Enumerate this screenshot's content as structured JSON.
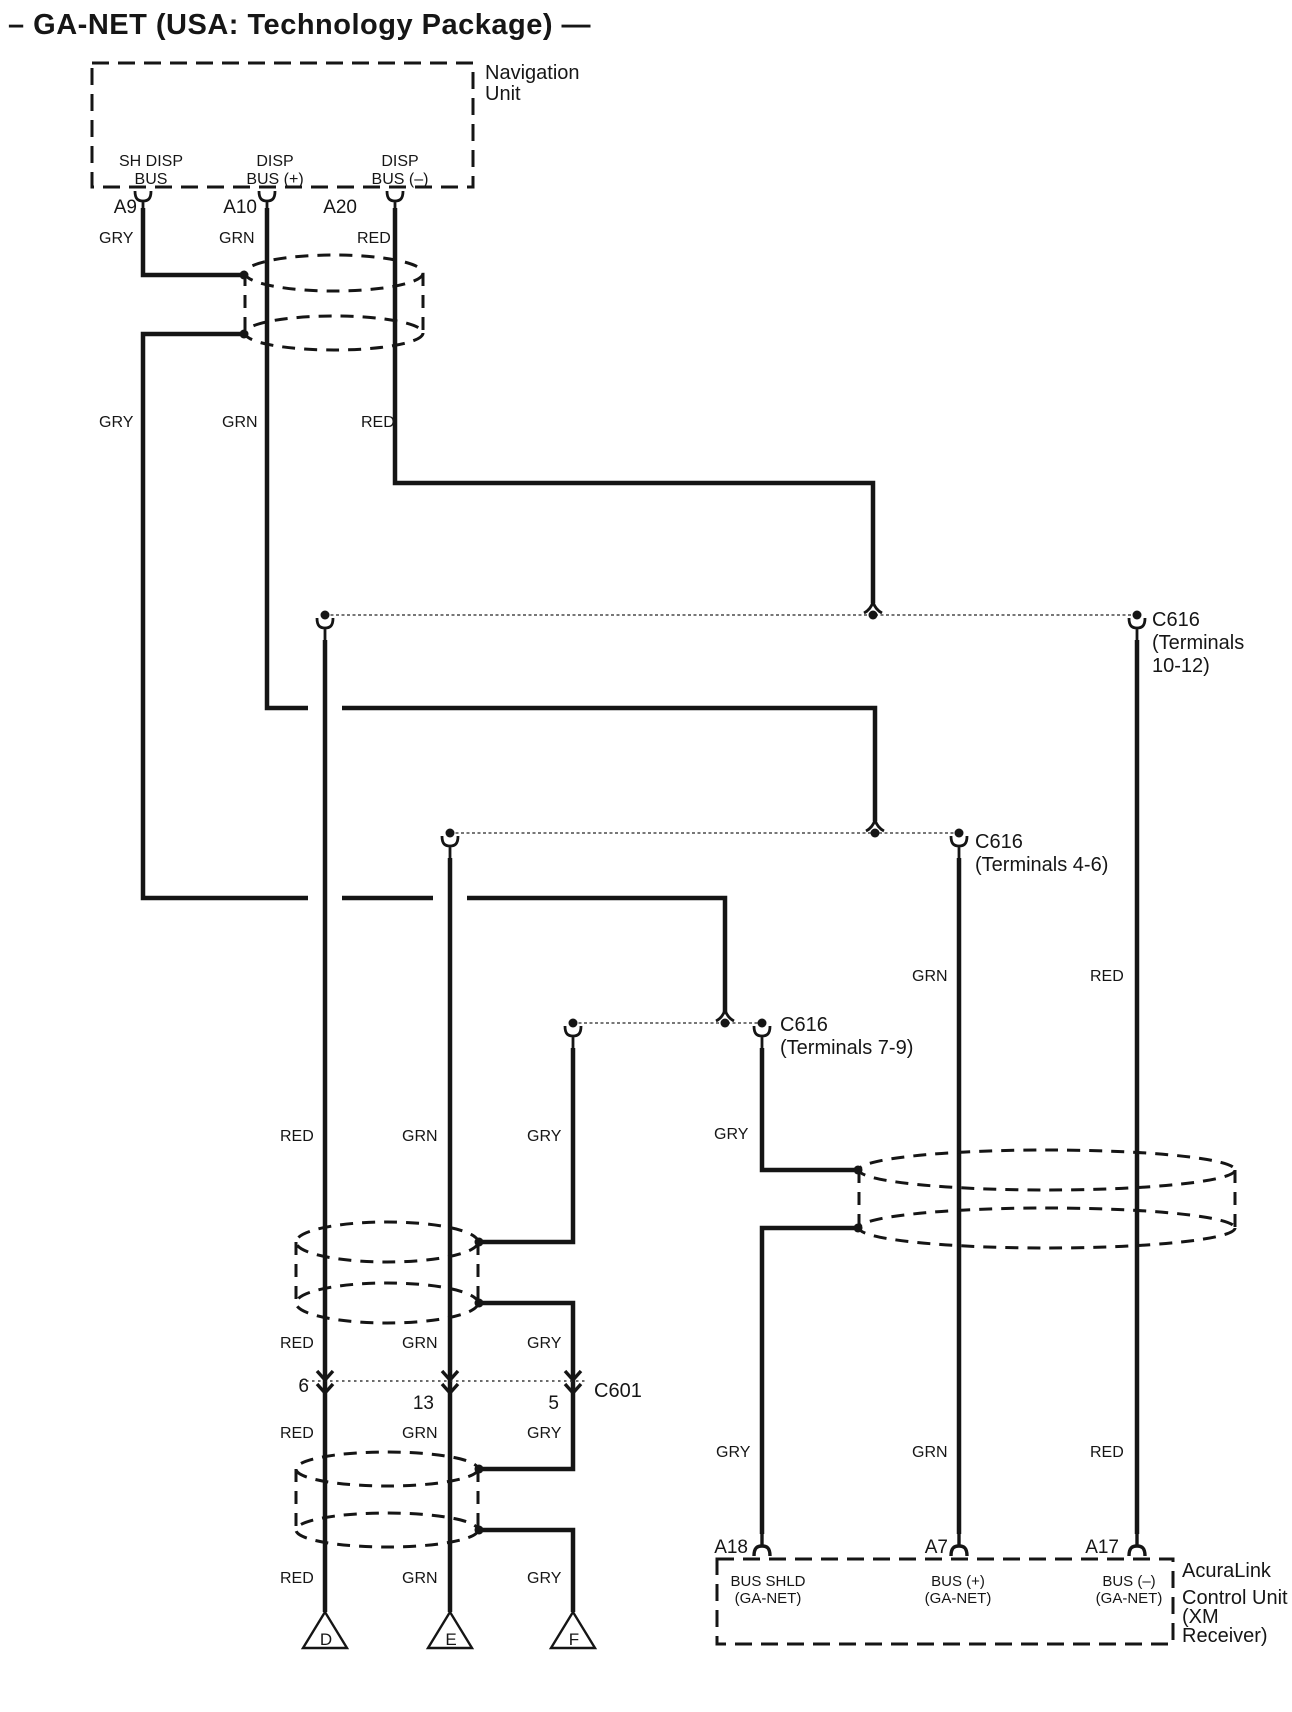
{
  "title": "– GA-NET (USA: Technology Package) —",
  "navigation_unit": {
    "label": [
      "Navigation",
      "Unit"
    ],
    "pins": [
      {
        "id": "A9",
        "bus": [
          "SH DISP",
          "BUS"
        ],
        "wire": "GRY"
      },
      {
        "id": "A10",
        "bus": [
          "DISP",
          "BUS (+)"
        ],
        "wire": "GRN"
      },
      {
        "id": "A20",
        "bus": [
          "DISP",
          "BUS (–)"
        ],
        "wire": "RED"
      }
    ]
  },
  "wire_labels": {
    "tier2": [
      "GRY",
      "GRN",
      "RED"
    ],
    "left_mid": [
      "RED",
      "GRN",
      "GRY"
    ],
    "left_above_c601": [
      "RED",
      "GRN",
      "GRY"
    ],
    "left_below_c601": [
      "RED",
      "GRN",
      "GRY"
    ],
    "left_bottom": [
      "RED",
      "GRN",
      "GRY"
    ],
    "right_upper": [
      "GRN",
      "RED"
    ],
    "right_gry": "GRY",
    "right_lower": [
      "GRY",
      "GRN",
      "RED"
    ]
  },
  "connectors": {
    "c616_10_12": [
      "C616",
      "(Terminals",
      "10-12)"
    ],
    "c616_4_6": [
      "C616",
      "(Terminals 4-6)"
    ],
    "c616_7_9": [
      "C616",
      "(Terminals 7-9)"
    ],
    "c601": {
      "label": "C601",
      "pins": [
        "6",
        "13",
        "5"
      ]
    }
  },
  "ring_terminals": [
    "D",
    "E",
    "F"
  ],
  "acuralink": {
    "label": [
      "AcuraLink",
      "Control Unit",
      "(XM",
      "Receiver)"
    ],
    "pins": [
      {
        "id": "A18",
        "bus": [
          "BUS SHLD",
          "(GA-NET)"
        ]
      },
      {
        "id": "A7",
        "bus": [
          "BUS (+)",
          "(GA-NET)"
        ]
      },
      {
        "id": "A17",
        "bus": [
          "BUS (–)",
          "(GA-NET)"
        ]
      }
    ]
  },
  "colors": {
    "ink": "#151515",
    "background": "#ffffff"
  }
}
